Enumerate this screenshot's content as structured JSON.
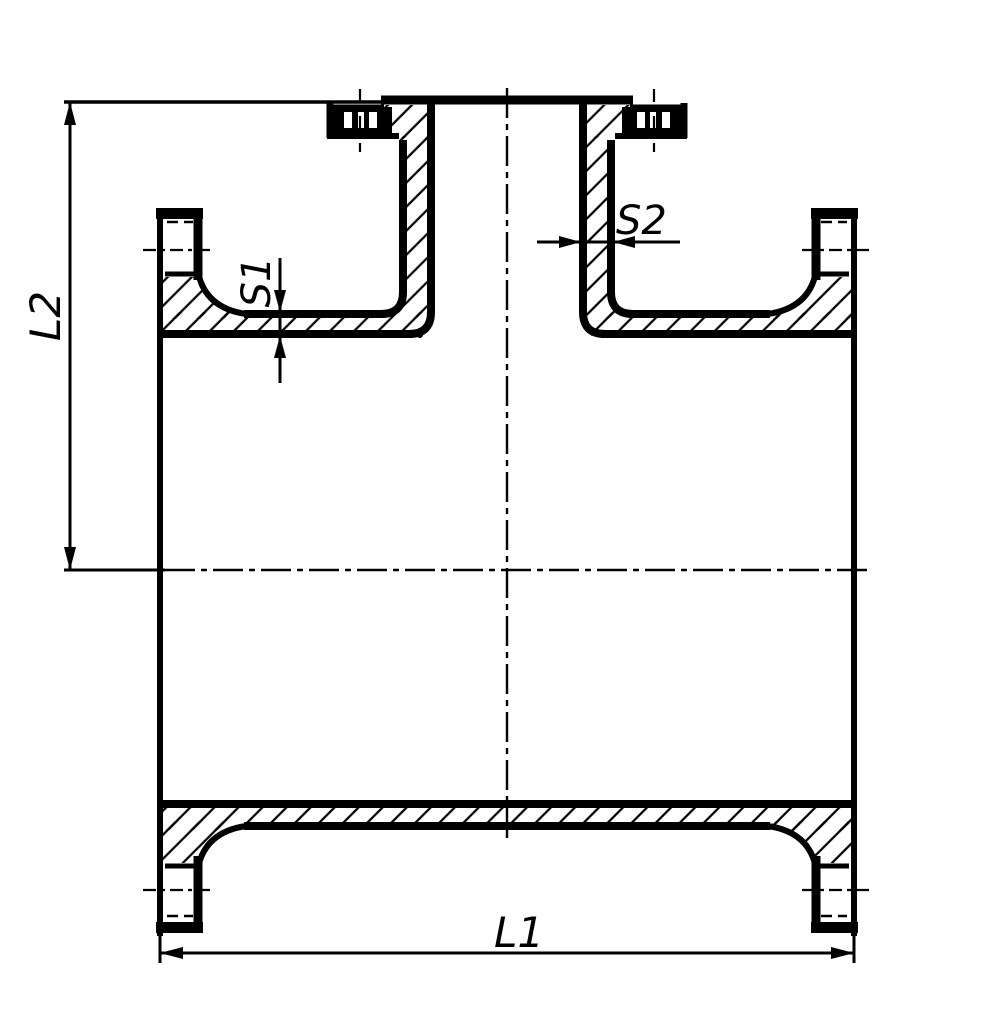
{
  "drawing": {
    "type": "technical-drawing",
    "subject": "flanged-tee-cross-section",
    "background_color": "#ffffff",
    "line_color": "#000000",
    "labels": {
      "run_length": "L1",
      "branch_height": "L2",
      "run_wall_thickness": "S1",
      "branch_wall_thickness": "S2"
    }
  }
}
